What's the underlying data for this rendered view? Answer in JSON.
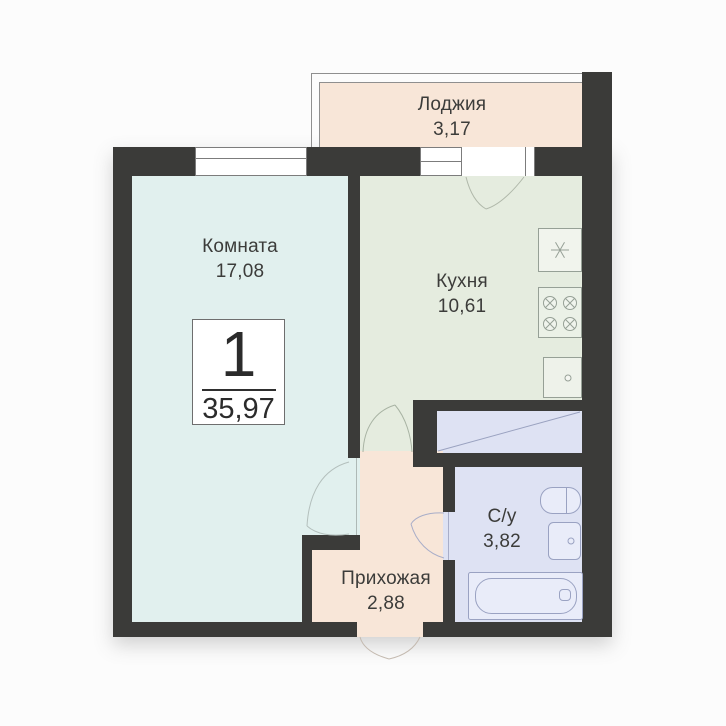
{
  "badge": {
    "rooms_count": "1",
    "total_area": "35,97"
  },
  "rooms": {
    "loggia": {
      "name": "Лоджия",
      "area": "3,17"
    },
    "living_room": {
      "name": "Комната",
      "area": "17,08"
    },
    "kitchen": {
      "name": "Кухня",
      "area": "10,61"
    },
    "bathroom": {
      "name": "С/у",
      "area": "3,82"
    },
    "hallway": {
      "name": "Прихожая",
      "area": "2,88"
    }
  },
  "colors": {
    "wall": "#3b3b39",
    "living_room_fill": "#e1f0ee",
    "kitchen_fill": "#e5ecdf",
    "loggia_fill": "#f8e6d8",
    "hallway_fill": "#f8e6d8",
    "bathroom_fill": "#dee2f3",
    "background": "#fcfcfc"
  }
}
